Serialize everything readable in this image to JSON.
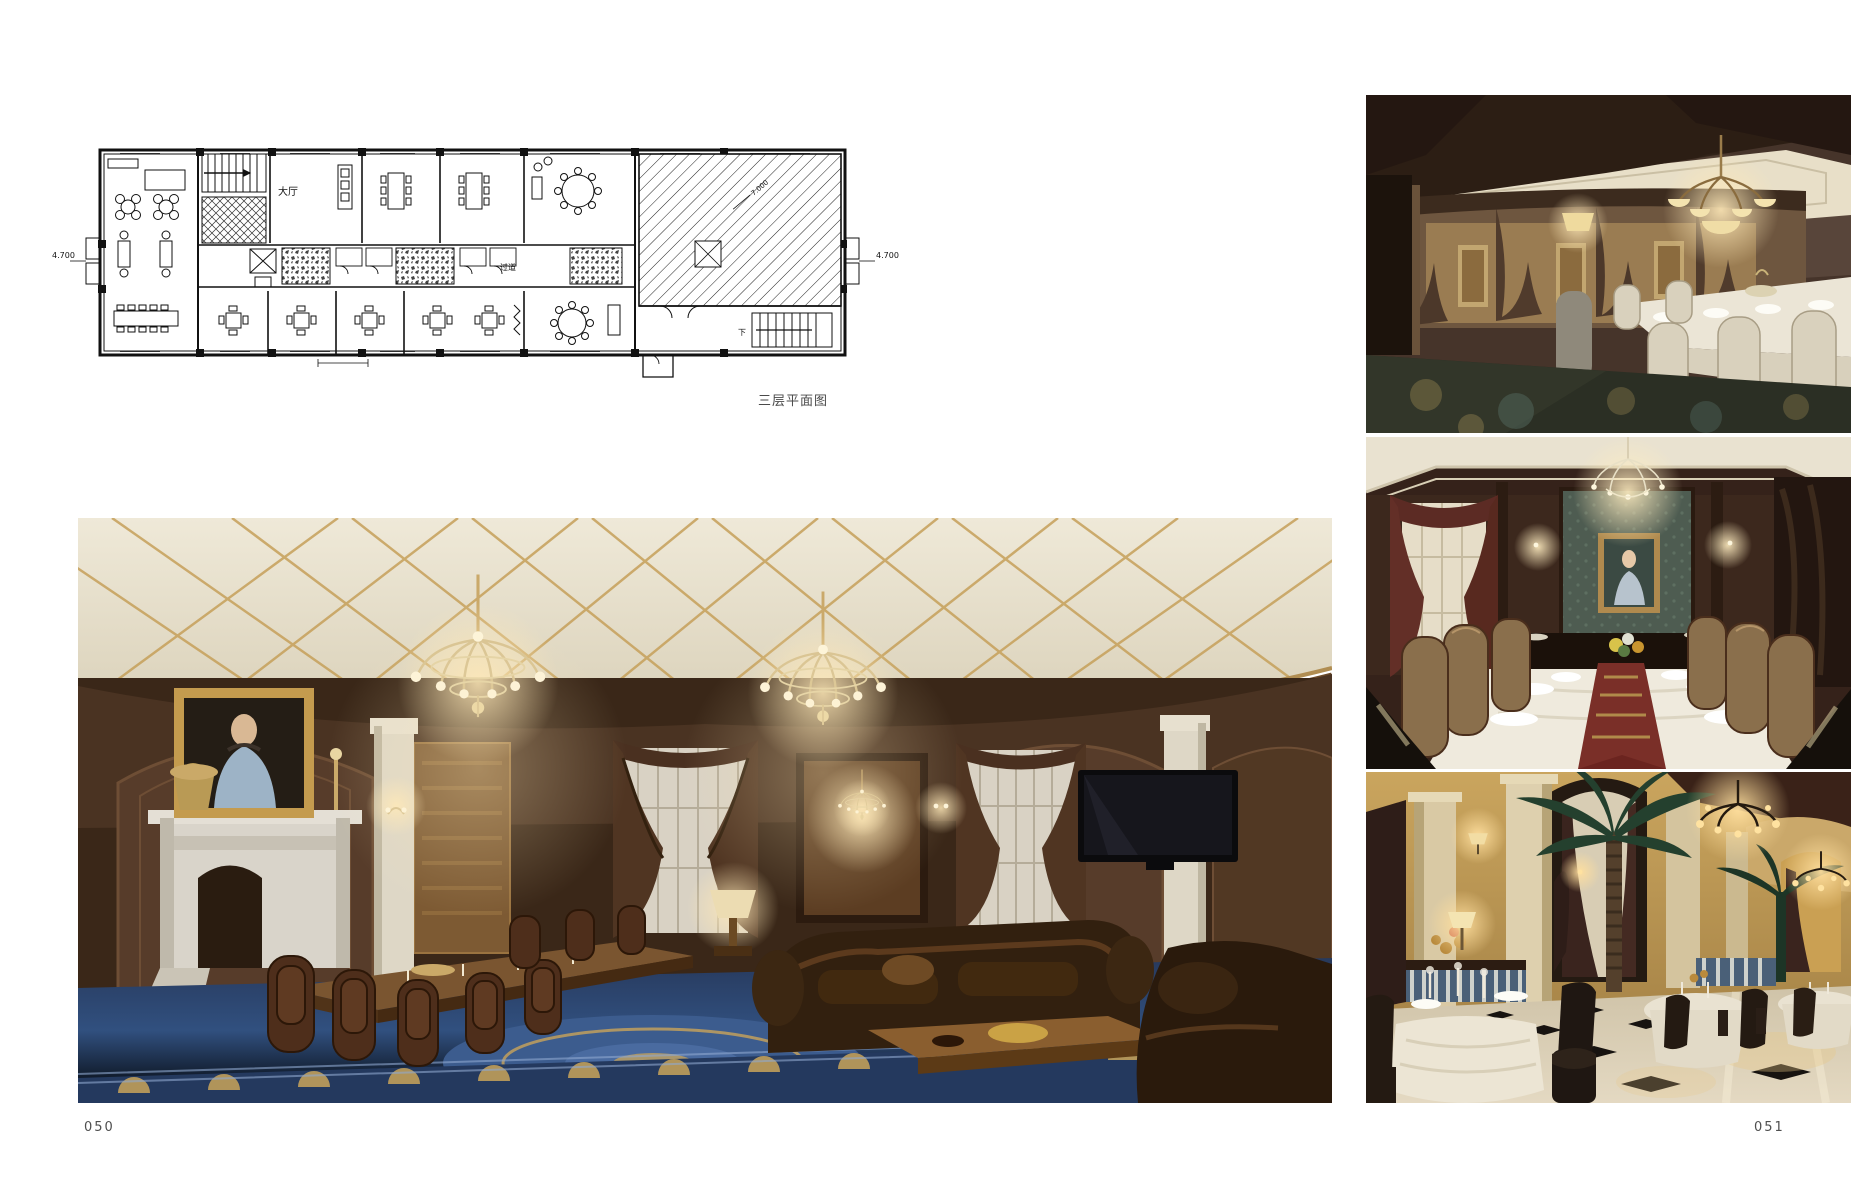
{
  "page": {
    "left_page_number": "050",
    "right_page_number": "051"
  },
  "floor_plan": {
    "caption": "三层平面图",
    "room_labels": {
      "hall": "大厅",
      "corridor": "过道"
    },
    "elevation_label": "7.000",
    "dimension_left": "4.700",
    "dimension_right": "4.700",
    "stair_down_label": "下"
  },
  "photos": {
    "main": {
      "name": "vip-dining-lounge-photo"
    },
    "right_top": {
      "name": "private-dining-long-table-photo"
    },
    "right_middle": {
      "name": "private-dining-portrait-room-photo"
    },
    "right_bottom": {
      "name": "grand-restaurant-hall-photo"
    }
  },
  "colors": {
    "plan_line": "#111111",
    "wood_brown": "#4a3322",
    "ceiling_cream": "#e9e2d0",
    "gold_trim": "#c6a05a",
    "carpet_blue": "#31507f",
    "marble_white": "#d8d3c9",
    "curtain_brown": "#50331f",
    "teal_wallpaper": "#4e5c51",
    "runner_maroon": "#7a2f28",
    "restaurant_gold": "#c29a55"
  }
}
